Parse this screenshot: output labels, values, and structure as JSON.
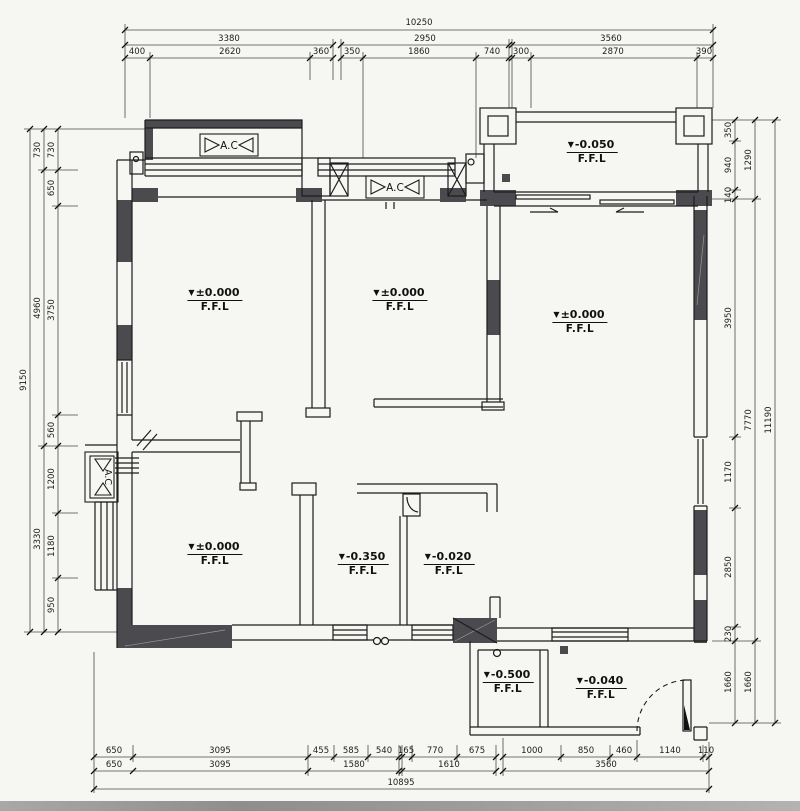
{
  "labels": {
    "ffl": "F.F.L",
    "ac": "A.C",
    "triangle": "▼"
  },
  "levels": {
    "balcony": "-0.050",
    "room_top_left": "±0.000",
    "room_top_middle": "±0.000",
    "living_room": "±0.000",
    "bedroom_bottom_left": "±0.000",
    "bathroom": "-0.350",
    "storage": "-0.020",
    "kitchen": "-0.500",
    "entry": "-0.040"
  },
  "dimensions": {
    "top": {
      "overall": "10250",
      "row2": [
        "3380",
        "2950",
        "3560"
      ],
      "row3": [
        "400",
        "2620",
        "360",
        "350",
        "1860",
        "740",
        "300",
        "2870",
        "390"
      ]
    },
    "bottom": {
      "row1": [
        "650",
        "3095",
        "455",
        "585",
        "540",
        "165",
        "770",
        "675",
        "1000",
        "850",
        "460",
        "1140",
        "110"
      ],
      "row2": [
        "650",
        "3095",
        "1580",
        "1610",
        "3560"
      ],
      "overall": "10895"
    },
    "left": {
      "inner": [
        "730",
        "650",
        "3750",
        "560",
        "1200",
        "1180",
        "950"
      ],
      "mid": [
        "730",
        "4960",
        "3330"
      ],
      "overall": "9150"
    },
    "right": {
      "inner": [
        "350",
        "940",
        "140",
        "3950",
        "1170",
        "2850",
        "230",
        "1660"
      ],
      "mid": [
        "1290",
        "7770",
        "1660"
      ],
      "overall": "11190"
    }
  }
}
